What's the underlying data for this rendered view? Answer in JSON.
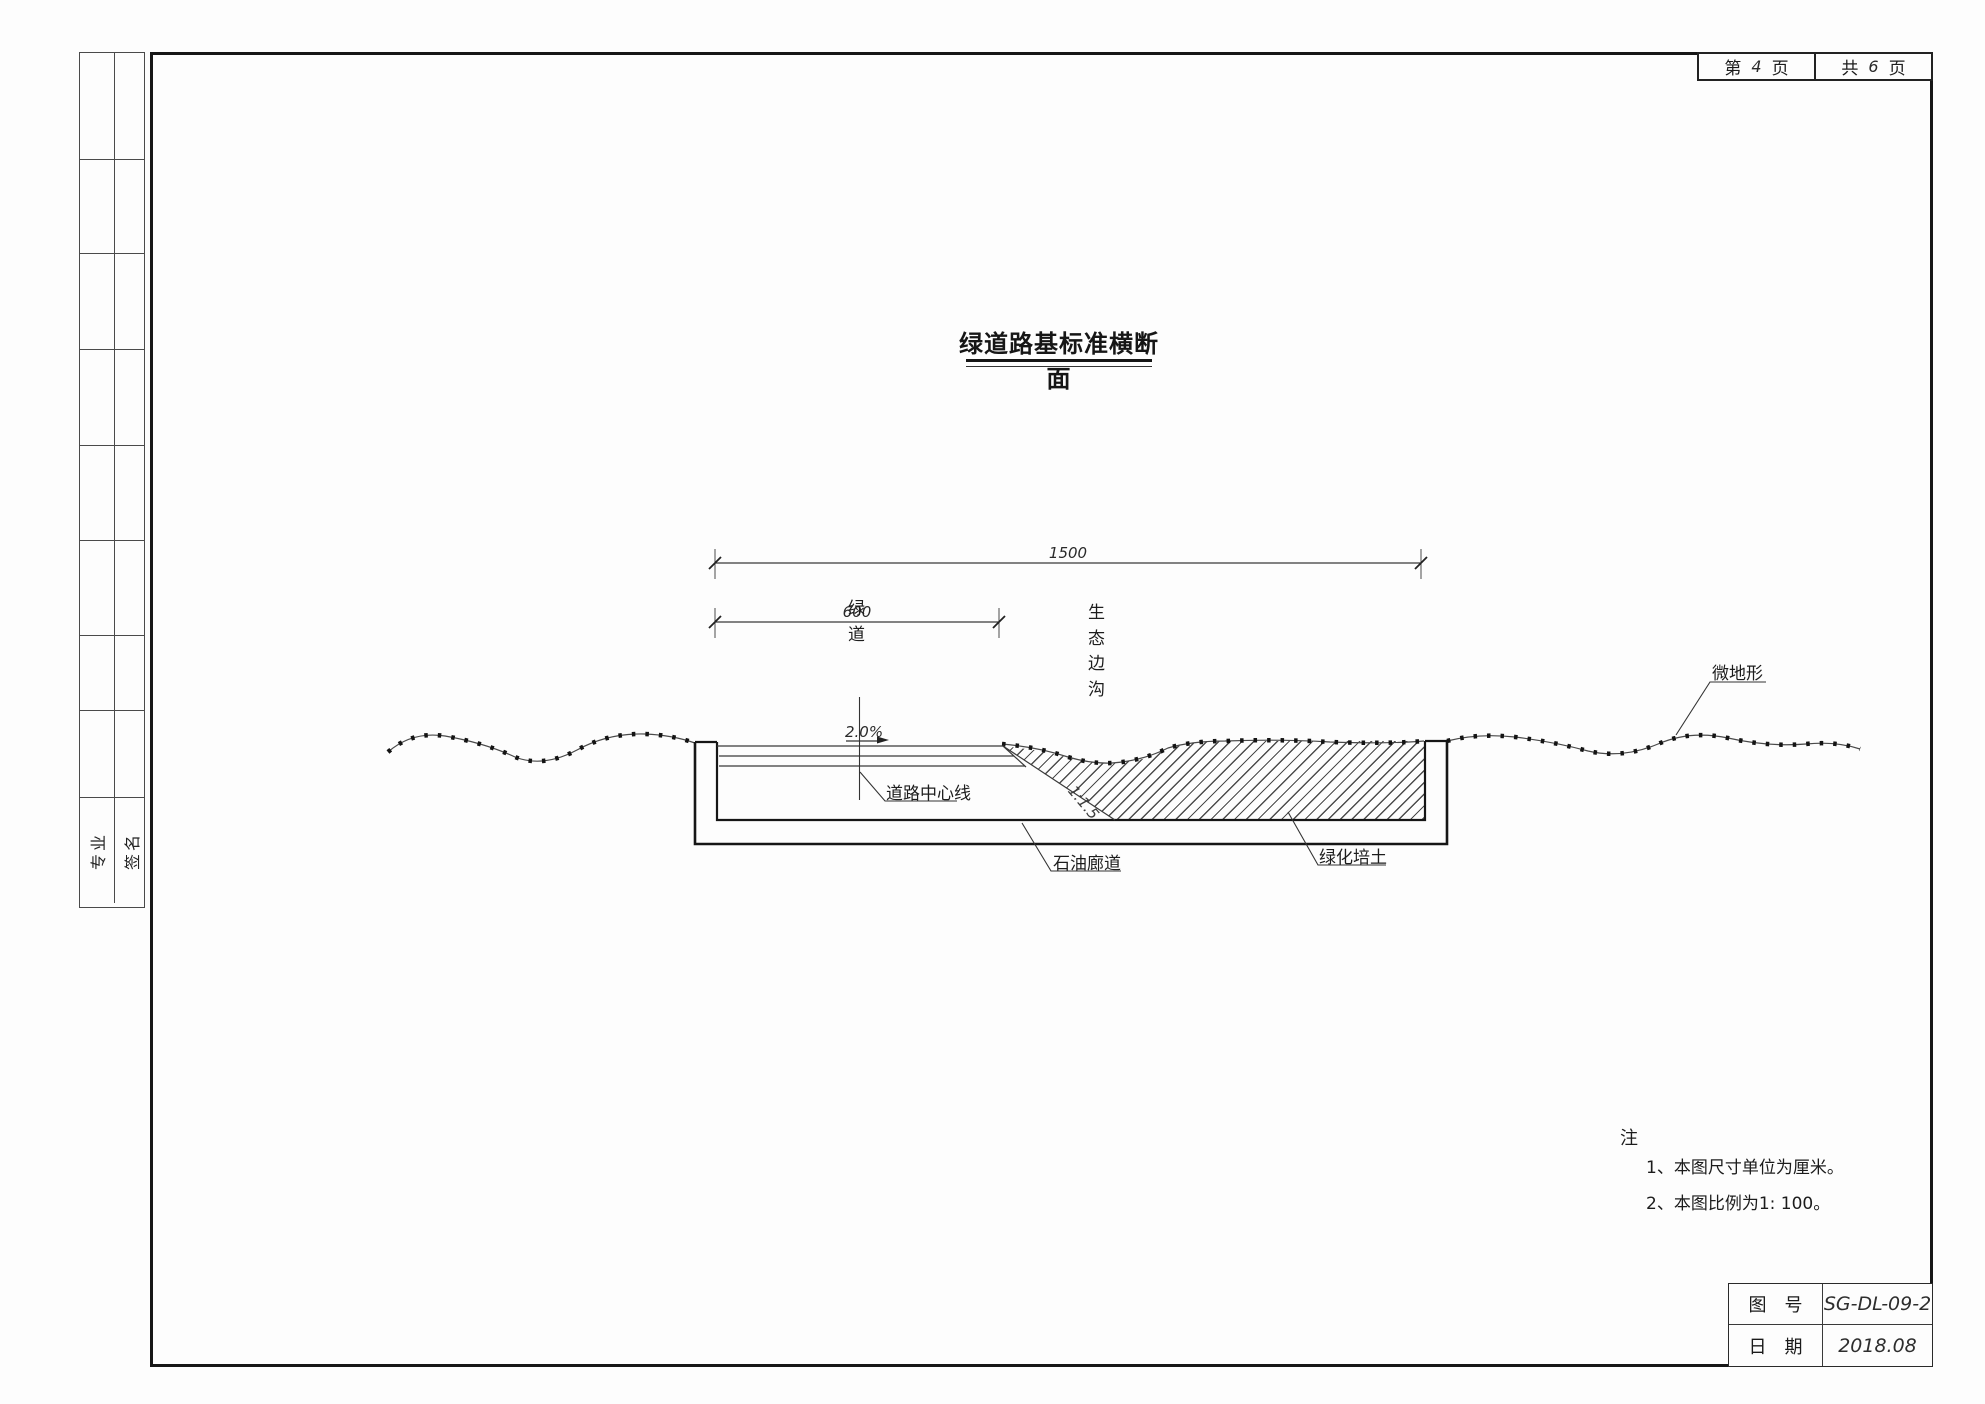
{
  "colors": {
    "ink": "#161616",
    "thin_line": "#3c3c3c",
    "background": "#fdfdfd"
  },
  "page_box": {
    "current_prefix": "第",
    "current_number": "4",
    "current_suffix": "页",
    "total_prefix": "共",
    "total_number": "6",
    "total_suffix": "页"
  },
  "title": "绿道路基标准横断面",
  "dims": {
    "overall": "1500",
    "greenway_width": "600",
    "cross_slope": "2.0%",
    "side_slope": "1:1.5"
  },
  "labels": {
    "greenway": "绿道",
    "eco_ditch": "生态边沟",
    "road_centerline": "道路中心线",
    "oil_corridor": "石油廊道",
    "greening_soil": "绿化培土",
    "micro_terrain": "微地形"
  },
  "sidebar": {
    "col1_label": "专业",
    "col2_label": "签名"
  },
  "notes": {
    "heading": "注",
    "items": [
      "1、本图尺寸单位为厘米。",
      "2、本图比例为1: 100。"
    ]
  },
  "title_block": {
    "rows": [
      {
        "label": "图　号",
        "value": "SG-DL-09-2"
      },
      {
        "label": "日　期",
        "value": "2018.08"
      }
    ]
  }
}
